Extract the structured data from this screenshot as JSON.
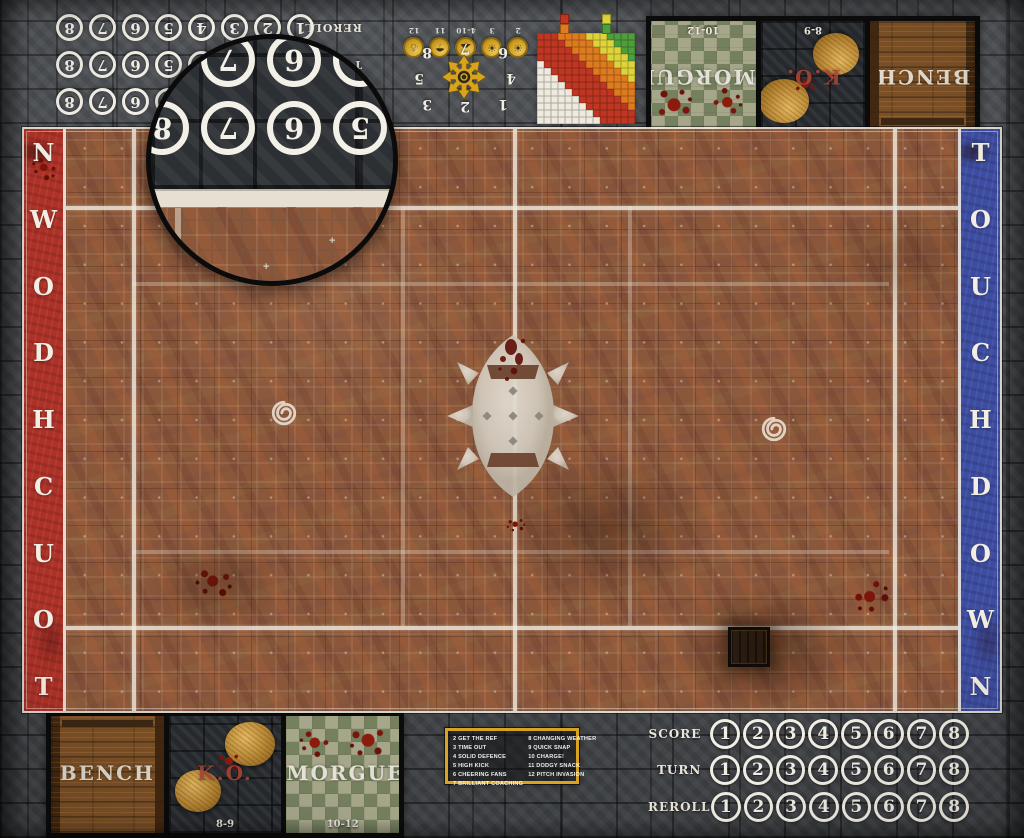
{
  "banners": {
    "left_text": "TOUCHDOWN",
    "right_text": "TOUCHDOWN",
    "left_color": "#ad3127",
    "right_color": "#3d4da1"
  },
  "tracks": {
    "labels": [
      "SCORE",
      "TURN",
      "REROLL"
    ],
    "numbers": [
      "1",
      "2",
      "3",
      "4",
      "5",
      "6",
      "7",
      "8"
    ]
  },
  "dugouts": {
    "bench_label": "BENCH",
    "ko_label": "K.O.",
    "ko_range": "8-9",
    "morgue_label": "MORGUE",
    "morgue_range": "10-12"
  },
  "weather": {
    "stops": [
      {
        "label": "2",
        "icon": "sun-icon",
        "glyph": "☀"
      },
      {
        "label": "3",
        "icon": "sun-small-cloud-icon",
        "glyph": "☀"
      },
      {
        "label": "4-10",
        "icon": "cloud-sun-icon",
        "glyph": "☁"
      },
      {
        "label": "11",
        "icon": "rain-icon",
        "glyph": "☂"
      },
      {
        "label": "12",
        "icon": "snow-icon",
        "glyph": "☃"
      }
    ]
  },
  "scatter": {
    "numbers": [
      "1",
      "2",
      "3",
      "4",
      "5",
      "6",
      "7",
      "8"
    ]
  },
  "kickoff_table": {
    "border_color": "#d9a322",
    "left": [
      "2 GET THE REF",
      "3 TIME OUT",
      "4 SOLID DEFENCE",
      "5 HIGH KICK",
      "6 CHEERING FANS",
      "7 BRILLIANT COACHING"
    ],
    "right": [
      "8 CHANGING WEATHER",
      "9 QUICK SNAP",
      "10 CHARGE!",
      "11 DODGY SNACK",
      "12 PITCH INVASION"
    ]
  },
  "range_ruler": {
    "cols": 14,
    "rows": 13,
    "band_limits": [
      3,
      6,
      10,
      16
    ],
    "colors": [
      "#4f9e3c",
      "#ded33b",
      "#de7b1f",
      "#bf3722",
      "#efeade"
    ],
    "key_left": [
      "#bf3722",
      "#de7b1f"
    ],
    "key_right": [
      "#ded33b",
      "#4f9e3c"
    ]
  },
  "magnifier": {
    "numbers": [
      "5",
      "6",
      "7",
      "8"
    ]
  },
  "field": {
    "line_color": "#f0eade",
    "turf_color": "#8a573b"
  }
}
